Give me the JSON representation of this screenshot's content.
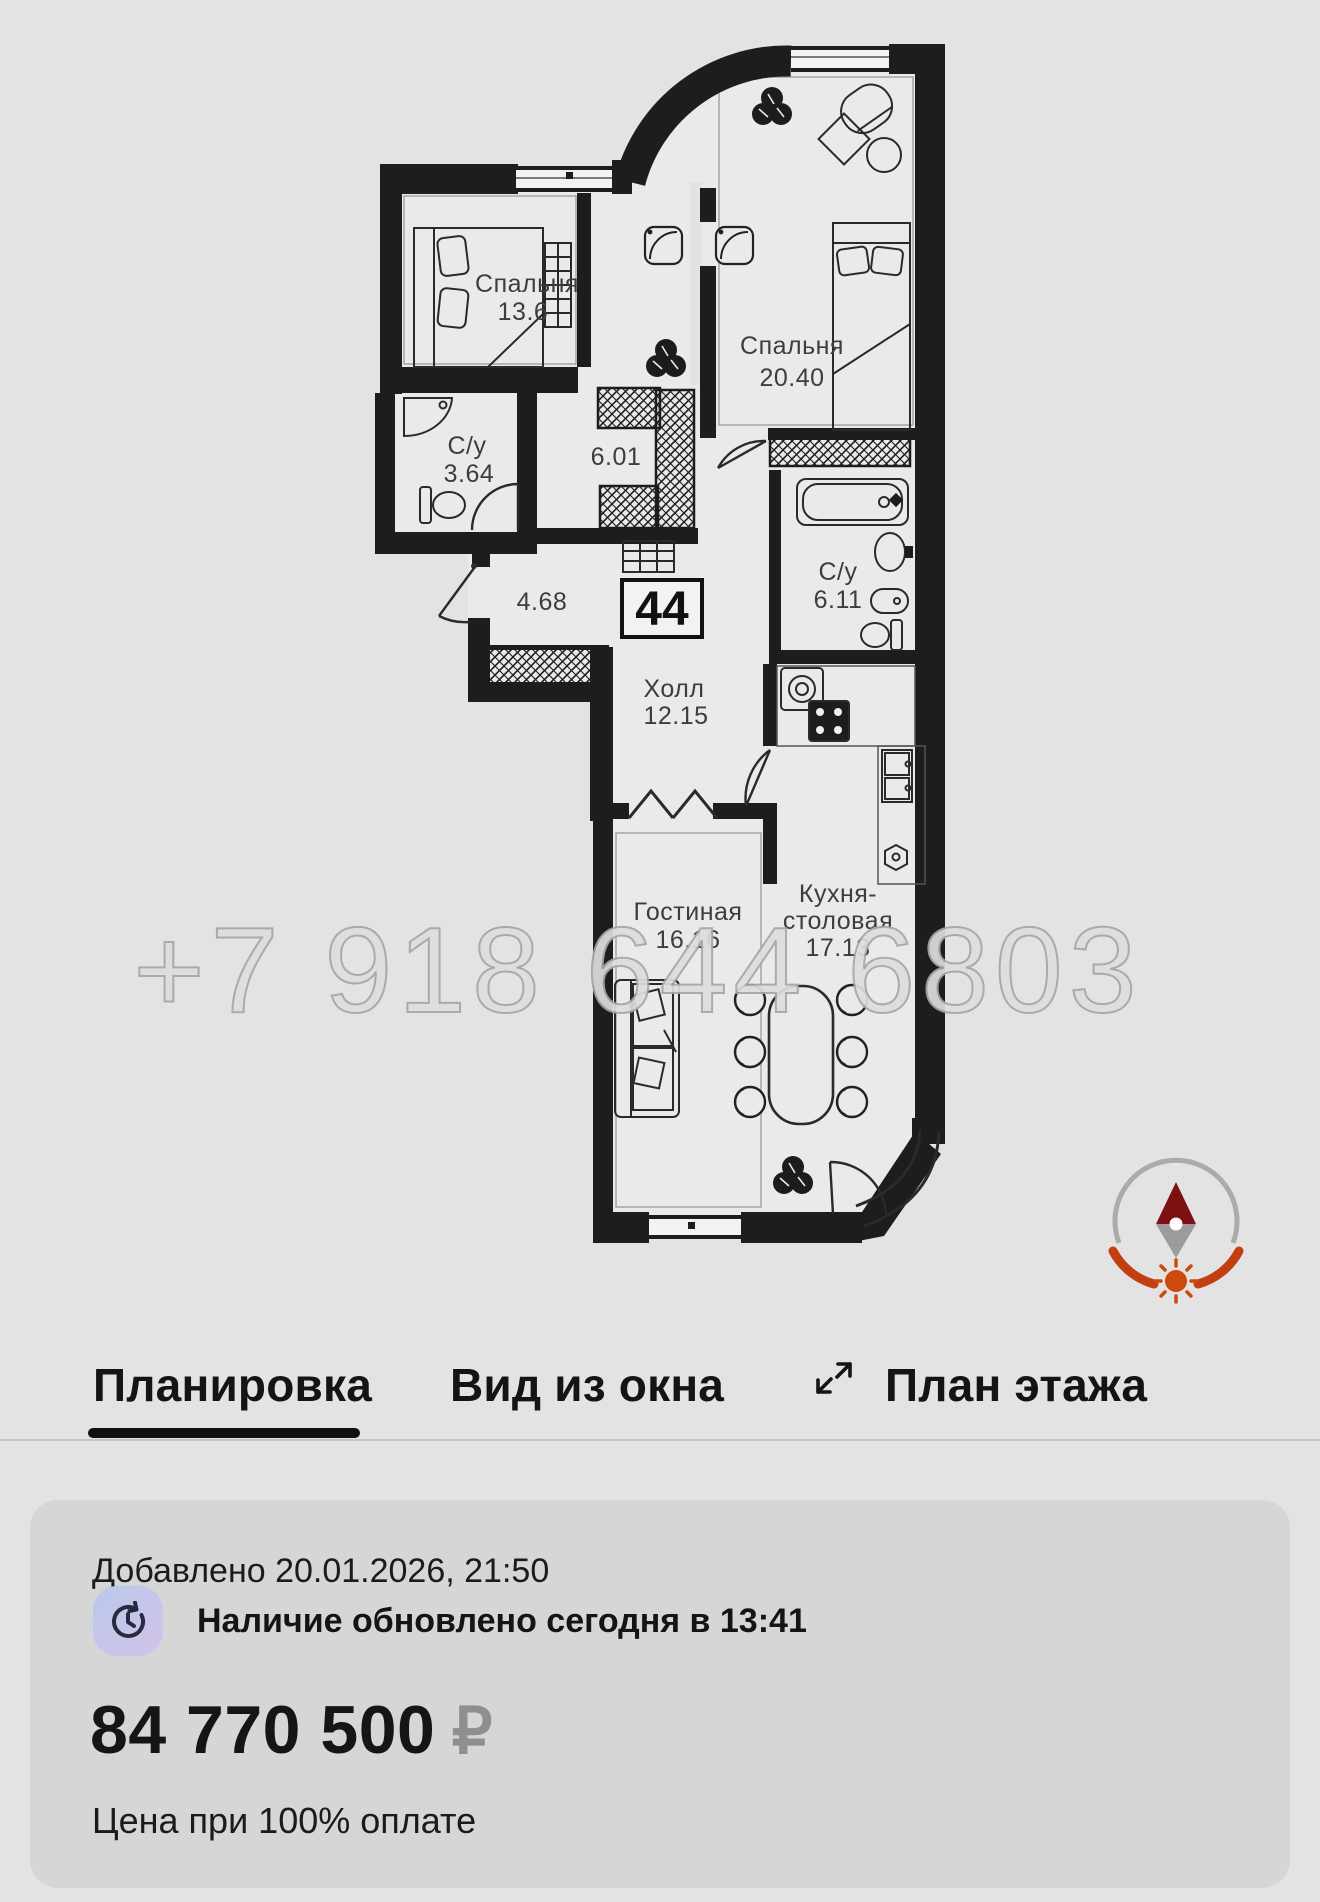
{
  "plan": {
    "badge_number": "44",
    "watermark_phone": "+7 918 644 6803",
    "rooms": {
      "bedroom1": {
        "name": "Спальня",
        "area": "13.6"
      },
      "bedroom2": {
        "name": "Спальня",
        "area": "20.40"
      },
      "bathroom1": {
        "name": "С/у",
        "area": "3.64"
      },
      "closet": {
        "area": "6.01"
      },
      "corridor": {
        "area": "4.68"
      },
      "bathroom2": {
        "name": "С/у",
        "area": "6.11"
      },
      "hall": {
        "name": "Холл",
        "area": "12.15"
      },
      "living": {
        "name": "Гостиная",
        "area": "16.16"
      },
      "kitchen": {
        "name_line1": "Кухня-",
        "name_line2": "столовая",
        "area": "17.13"
      }
    },
    "colors": {
      "walls": "#1d1d1d",
      "compass_red": "#c23f10",
      "compass_needle": "#7d1012"
    }
  },
  "tabs": [
    {
      "label": "Планировка",
      "active": true
    },
    {
      "label": "Вид из окна",
      "active": false
    },
    {
      "label": "План этажа",
      "active": false
    }
  ],
  "details_card": {
    "added_line": "Добавлено 20.01.2026, 21:50",
    "availability_line": "Наличие обновлено сегодня в 13:41",
    "price": "84 770 500",
    "currency_symbol": "₽",
    "price_note": "Цена при 100% оплате"
  }
}
